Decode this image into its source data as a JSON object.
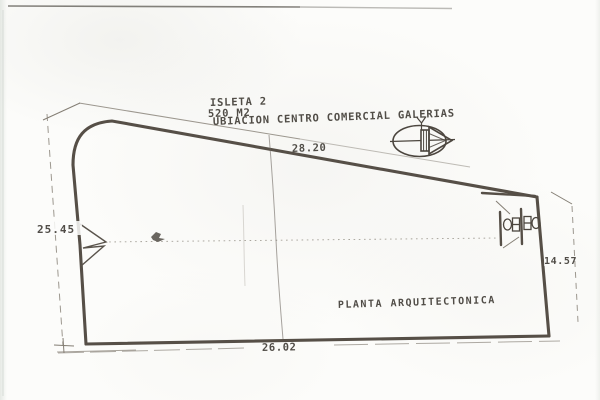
{
  "plan": {
    "isleta": "ISLETA 2",
    "area": "520 M2",
    "location": "UBIACION CENTRO COMERCIAL GALERIAS",
    "title": "PLANTA ARQUITECTONICA",
    "dimensions": {
      "top": "28.20",
      "left": "25.45",
      "right": "14.57",
      "bottom": "26.02"
    }
  },
  "icons": {
    "compass": "north-arrow-compass",
    "fixtures": "wc-toilet-symbols",
    "notch": "entrance-notch-mark"
  },
  "colors": {
    "paper": "#fcfcfa",
    "wall": "#564f47",
    "thin_line": "#847e74",
    "text": "#3f3b35"
  }
}
